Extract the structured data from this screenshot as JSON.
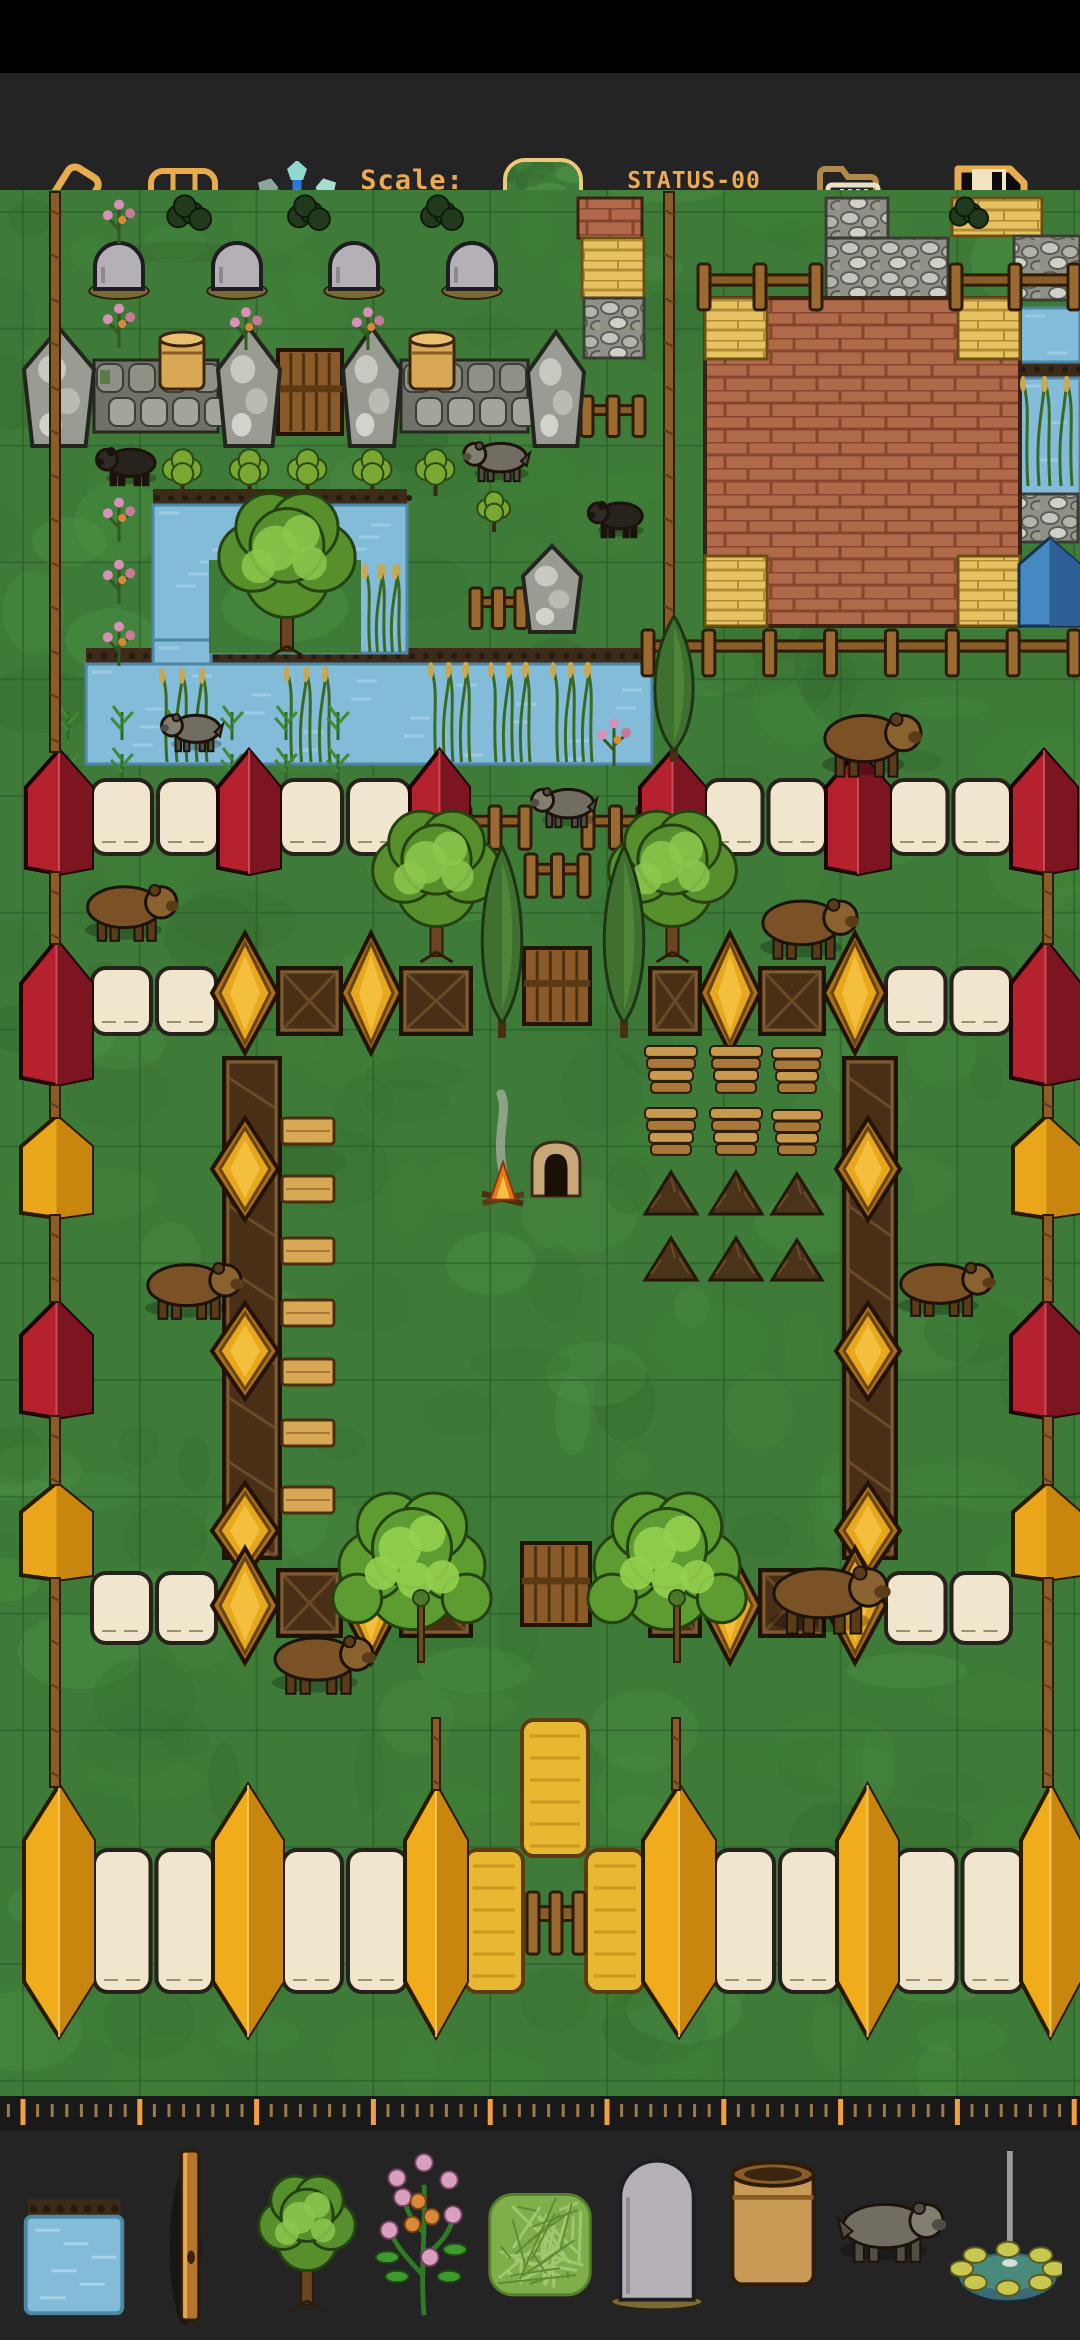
{
  "app": {
    "scale_label": "Scale:",
    "scale_value": "61%",
    "status_line1": "STATUS-00",
    "status_line2": "ver 1.1.2 beta"
  },
  "colors": {
    "accent_gold": "#edaa55",
    "toolbar_bg": "#242424",
    "grass": "#3e7b38",
    "grid_line": "#2a5a28",
    "water": "#82bcd8",
    "soil": "#3d2b1a",
    "red_post": "#b5222e",
    "cream_wall": "#efe6cd",
    "gold_post": "#e8a81e",
    "brown_wall": "#4a2f17",
    "hay": "#e8b832",
    "icon_blue": "#2a78d8",
    "icon_cyan": "#3ed8c8"
  },
  "toolbar": {
    "buttons": [
      {
        "name": "eraser-icon",
        "x": 30,
        "y": 95
      },
      {
        "name": "grid-icon",
        "x": 146,
        "y": 95
      },
      {
        "name": "snowflake-icon",
        "x": 252,
        "y": 92
      },
      {
        "name": "open-folder-icon",
        "x": 812,
        "y": 90
      },
      {
        "name": "save-icon",
        "x": 948,
        "y": 88
      }
    ],
    "selected_tile": "grass-tile"
  },
  "ruler": {
    "major_start": 23,
    "major_spacing": 116.8,
    "major_count": 10,
    "minor_step": 14.6,
    "major_color": "#f0a040",
    "minor_color": "#9a7a4a"
  },
  "palette": {
    "items": [
      {
        "name": "water-tile"
      },
      {
        "name": "wood-pole"
      },
      {
        "name": "tree"
      },
      {
        "name": "flowering-plant"
      },
      {
        "name": "grass-tile"
      },
      {
        "name": "gravestone"
      },
      {
        "name": "barrel"
      },
      {
        "name": "wolf"
      },
      {
        "name": "fountain"
      }
    ]
  },
  "map": {
    "grid": {
      "x0": 23,
      "y0": 212,
      "step": 116.8
    },
    "features": [
      [
        "soil",
        153,
        489,
        254,
        18
      ],
      [
        "soil",
        86,
        648,
        566,
        16
      ],
      [
        "soil",
        1019,
        360,
        61,
        18
      ],
      [
        "water",
        153,
        505,
        254,
        148
      ],
      [
        "water",
        153,
        640,
        58,
        30
      ],
      [
        "water",
        86,
        664,
        566,
        100
      ],
      [
        "water",
        1019,
        308,
        61,
        54
      ],
      [
        "water",
        1019,
        378,
        61,
        122
      ],
      [
        "island",
        209,
        560,
        152,
        93
      ],
      [
        "brick_tile",
        578,
        198,
        64,
        40
      ],
      [
        "stone_tile",
        826,
        198,
        62,
        40
      ],
      [
        "stone_tile",
        826,
        238,
        122,
        122
      ],
      [
        "yellow_tile",
        952,
        198,
        90,
        38
      ],
      [
        "yellow_tile",
        582,
        238,
        62,
        60
      ],
      [
        "stone_tile",
        584,
        298,
        60,
        60
      ],
      [
        "stone_tile",
        1014,
        236,
        66,
        64
      ],
      [
        "stone_tile",
        1016,
        494,
        62,
        48
      ],
      [
        "building",
        705,
        298,
        315,
        328
      ],
      [
        "fence",
        698,
        264,
        124,
        34
      ],
      [
        "fence",
        950,
        264,
        130,
        34
      ],
      [
        "fence",
        581,
        396,
        64,
        30
      ],
      [
        "fence",
        470,
        588,
        57,
        30
      ],
      [
        "fence",
        642,
        630,
        438,
        34
      ],
      [
        "swall",
        94,
        360,
        124,
        72
      ],
      [
        "swall",
        401,
        360,
        127,
        72
      ],
      [
        "gate",
        278,
        350,
        64,
        84
      ],
      [
        "spost",
        24,
        328,
        70,
        118
      ],
      [
        "spost",
        218,
        328,
        62,
        118
      ],
      [
        "spost",
        343,
        328,
        58,
        118
      ],
      [
        "spost",
        528,
        332,
        56,
        114
      ],
      [
        "spost",
        523,
        546,
        58,
        86
      ],
      [
        "barrel",
        160,
        331,
        44,
        58
      ],
      [
        "barrel",
        410,
        331,
        44,
        58
      ],
      [
        "tent",
        1019,
        538,
        61,
        88
      ],
      [
        "gravestone",
        95,
        243,
        48,
        52
      ],
      [
        "gravestone",
        213,
        243,
        48,
        52
      ],
      [
        "gravestone",
        330,
        243,
        48,
        52
      ],
      [
        "gravestone",
        448,
        243,
        48,
        52
      ],
      [
        "bush_dark",
        165,
        196,
        44,
        34
      ],
      [
        "bush_dark",
        287,
        196,
        40,
        34
      ],
      [
        "bush_dark",
        420,
        196,
        40,
        34
      ],
      [
        "bush_dark",
        948,
        198,
        38,
        30
      ],
      [
        "flower",
        103,
        196,
        32,
        48
      ],
      [
        "flower",
        103,
        300,
        32,
        48
      ],
      [
        "flower",
        230,
        304,
        32,
        46
      ],
      [
        "flower",
        352,
        304,
        32,
        46
      ],
      [
        "flower",
        103,
        494,
        32,
        48
      ],
      [
        "flower",
        103,
        556,
        32,
        48
      ],
      [
        "flower",
        103,
        618,
        32,
        48
      ],
      [
        "flower",
        597,
        714,
        34,
        52
      ],
      [
        "bush",
        160,
        450,
        45,
        46
      ],
      [
        "bush",
        227,
        450,
        45,
        46
      ],
      [
        "bush",
        285,
        450,
        45,
        46
      ],
      [
        "bush",
        350,
        450,
        45,
        46
      ],
      [
        "bush",
        413,
        450,
        45,
        46
      ],
      [
        "bush",
        475,
        492,
        38,
        40
      ],
      [
        "reeds",
        163,
        670,
        48,
        92
      ],
      [
        "reeds",
        288,
        668,
        46,
        94
      ],
      [
        "reeds",
        366,
        566,
        38,
        86
      ],
      [
        "reeds",
        432,
        664,
        42,
        98
      ],
      [
        "reeds",
        492,
        664,
        42,
        98
      ],
      [
        "reeds",
        554,
        664,
        42,
        98
      ],
      [
        "reeds",
        1024,
        378,
        52,
        108
      ],
      [
        "crop",
        50,
        700,
        36,
        40
      ],
      [
        "crop",
        104,
        700,
        36,
        40
      ],
      [
        "crop",
        158,
        704,
        36,
        40
      ],
      [
        "crop",
        214,
        700,
        36,
        40
      ],
      [
        "crop",
        268,
        700,
        36,
        40
      ],
      [
        "crop",
        320,
        700,
        36,
        40
      ],
      [
        "crop",
        50,
        742,
        36,
        40
      ],
      [
        "crop",
        104,
        742,
        36,
        40
      ],
      [
        "crop",
        214,
        742,
        36,
        40
      ],
      [
        "crop",
        268,
        742,
        36,
        40
      ],
      [
        "crop",
        320,
        742,
        36,
        40
      ],
      [
        "cream",
        92,
        780,
        126,
        74
      ],
      [
        "cream",
        280,
        780,
        130,
        74
      ],
      [
        "cream",
        705,
        780,
        121,
        74
      ],
      [
        "cream",
        890,
        780,
        121,
        74
      ],
      [
        "fence",
        459,
        806,
        72,
        32
      ],
      [
        "fence",
        582,
        806,
        67,
        32
      ],
      [
        "fence",
        525,
        854,
        65,
        32
      ],
      [
        "red",
        26,
        750,
        66,
        124
      ],
      [
        "red",
        218,
        750,
        62,
        124
      ],
      [
        "red",
        410,
        750,
        59,
        124
      ],
      [
        "red",
        640,
        750,
        65,
        124
      ],
      [
        "red",
        826,
        750,
        64,
        124
      ],
      [
        "red",
        1011,
        750,
        66,
        124
      ],
      [
        "cream",
        92,
        968,
        124,
        66
      ],
      [
        "cream",
        886,
        968,
        125,
        66
      ],
      [
        "brown",
        278,
        968,
        63,
        66
      ],
      [
        "brown",
        401,
        968,
        70,
        66
      ],
      [
        "brown",
        650,
        968,
        50,
        66
      ],
      [
        "brown",
        760,
        968,
        64,
        66
      ],
      [
        "gate",
        524,
        948,
        66,
        76
      ],
      [
        "gold",
        212,
        933,
        66,
        120
      ],
      [
        "gold",
        341,
        933,
        60,
        120
      ],
      [
        "gold",
        700,
        933,
        60,
        120
      ],
      [
        "gold",
        824,
        933,
        62,
        120
      ],
      [
        "red",
        21,
        940,
        71,
        145
      ],
      [
        "red",
        1011,
        940,
        69,
        145
      ],
      [
        "brown",
        224,
        1058,
        56,
        500
      ],
      [
        "brown",
        844,
        1058,
        52,
        500
      ],
      [
        "gold",
        212,
        1118,
        66,
        102
      ],
      [
        "gold",
        836,
        1118,
        64,
        102
      ],
      [
        "gold",
        212,
        1303,
        66,
        96
      ],
      [
        "gold",
        836,
        1303,
        64,
        96
      ],
      [
        "gold",
        212,
        1483,
        66,
        95
      ],
      [
        "gold",
        836,
        1483,
        64,
        95
      ],
      [
        "yellow",
        21,
        1116,
        71,
        102
      ],
      [
        "yellow",
        1013,
        1116,
        67,
        102
      ],
      [
        "red",
        21,
        1300,
        71,
        118
      ],
      [
        "red",
        1011,
        1300,
        69,
        118
      ],
      [
        "yellow",
        21,
        1483,
        71,
        97
      ],
      [
        "yellow",
        1013,
        1483,
        67,
        97
      ],
      [
        "cream",
        92,
        1573,
        124,
        70
      ],
      [
        "cream",
        886,
        1573,
        125,
        70
      ],
      [
        "brown",
        278,
        1570,
        63,
        66
      ],
      [
        "brown",
        401,
        1570,
        70,
        66
      ],
      [
        "brown",
        650,
        1570,
        50,
        66
      ],
      [
        "brown",
        760,
        1570,
        64,
        66
      ],
      [
        "gold",
        212,
        1548,
        66,
        115
      ],
      [
        "gold",
        341,
        1548,
        60,
        115
      ],
      [
        "gold",
        700,
        1548,
        60,
        115
      ],
      [
        "gold",
        824,
        1548,
        62,
        115
      ],
      [
        "gate",
        522,
        1543,
        68,
        82
      ],
      [
        "hay",
        522,
        1720,
        66,
        136
      ],
      [
        "hay",
        465,
        1850,
        58,
        142
      ],
      [
        "hay",
        586,
        1850,
        58,
        142
      ],
      [
        "cream2",
        94,
        1850,
        119,
        142
      ],
      [
        "cream2",
        283,
        1850,
        124,
        142
      ],
      [
        "cream2",
        715,
        1850,
        124,
        142
      ],
      [
        "cream2",
        896,
        1850,
        127,
        142
      ],
      [
        "fence",
        527,
        1892,
        58,
        46
      ],
      [
        "ypost",
        24,
        1785,
        70,
        252
      ],
      [
        "ypost",
        213,
        1785,
        70,
        252
      ],
      [
        "ypost",
        405,
        1785,
        62,
        252
      ],
      [
        "ypost",
        643,
        1785,
        72,
        252
      ],
      [
        "ypost",
        837,
        1785,
        61,
        252
      ],
      [
        "ypost",
        1021,
        1785,
        59,
        252
      ],
      [
        "pole",
        50,
        192,
        10,
        560
      ],
      [
        "pole",
        664,
        192,
        10,
        452
      ],
      [
        "pole",
        50,
        872,
        10,
        72
      ],
      [
        "pole",
        50,
        1085,
        10,
        33
      ],
      [
        "pole",
        50,
        1215,
        10,
        87
      ],
      [
        "pole",
        50,
        1416,
        10,
        69
      ],
      [
        "pole",
        50,
        1578,
        10,
        209
      ],
      [
        "pole",
        1043,
        872,
        10,
        72
      ],
      [
        "pole",
        1043,
        1085,
        10,
        33
      ],
      [
        "pole",
        1043,
        1215,
        10,
        87
      ],
      [
        "pole",
        1043,
        1416,
        10,
        69
      ],
      [
        "pole",
        1043,
        1578,
        10,
        209
      ],
      [
        "pole",
        432,
        1718,
        8,
        72
      ],
      [
        "pole",
        672,
        1718,
        8,
        72
      ],
      [
        "plank",
        282,
        1118,
        52,
        26
      ],
      [
        "plank",
        282,
        1176,
        52,
        26
      ],
      [
        "plank",
        282,
        1238,
        52,
        26
      ],
      [
        "plank",
        282,
        1300,
        52,
        26
      ],
      [
        "plank",
        282,
        1359,
        52,
        26
      ],
      [
        "plank",
        282,
        1420,
        52,
        26
      ],
      [
        "plank",
        282,
        1487,
        52,
        26
      ],
      [
        "campfire",
        482,
        1152,
        42,
        56
      ],
      [
        "kiln",
        532,
        1142,
        48,
        54
      ],
      [
        "logpile",
        645,
        1046,
        52,
        48
      ],
      [
        "logpile",
        710,
        1046,
        52,
        48
      ],
      [
        "logpile",
        772,
        1048,
        50,
        46
      ],
      [
        "logpile",
        645,
        1108,
        52,
        48
      ],
      [
        "logpile",
        710,
        1108,
        52,
        48
      ],
      [
        "logpile",
        772,
        1110,
        50,
        46
      ],
      [
        "brush",
        645,
        1172,
        52,
        42
      ],
      [
        "brush",
        710,
        1172,
        52,
        42
      ],
      [
        "brush",
        772,
        1174,
        50,
        40
      ],
      [
        "brush",
        645,
        1238,
        52,
        42
      ],
      [
        "brush",
        710,
        1238,
        52,
        42
      ],
      [
        "brush",
        772,
        1240,
        50,
        40
      ],
      [
        "tree",
        216,
        498,
        142,
        148
      ],
      [
        "tree",
        370,
        816,
        133,
        136
      ],
      [
        "tree",
        606,
        816,
        133,
        136
      ],
      [
        "cypress",
        644,
        616,
        60,
        146
      ],
      [
        "cypress",
        471,
        846,
        62,
        192
      ],
      [
        "cypress",
        593,
        846,
        62,
        192
      ],
      [
        "bigbush",
        336,
        1476,
        152,
        180
      ],
      [
        "bigbush",
        591,
        1476,
        152,
        180
      ],
      [
        "sapling",
        418,
        1592,
        10,
        70
      ],
      [
        "sapling",
        674,
        1592,
        10,
        70
      ],
      [
        "boar",
        98,
        446,
        60,
        40,
        1
      ],
      [
        "boar",
        590,
        500,
        55,
        38,
        1
      ],
      [
        "wolfa",
        465,
        440,
        65,
        42,
        1
      ],
      [
        "wolfa",
        533,
        786,
        64,
        42,
        1
      ],
      [
        "wolfa",
        163,
        712,
        60,
        40,
        1
      ],
      [
        "bear",
        820,
        710,
        98,
        68,
        0
      ],
      [
        "bear",
        83,
        882,
        92,
        60,
        0
      ],
      [
        "bear",
        758,
        896,
        97,
        64,
        0
      ],
      [
        "bear",
        143,
        1260,
        97,
        60,
        0
      ],
      [
        "bear",
        896,
        1260,
        96,
        57,
        0
      ],
      [
        "bear",
        768,
        1563,
        118,
        72,
        0
      ],
      [
        "bear",
        270,
        1633,
        102,
        62,
        0
      ]
    ]
  }
}
